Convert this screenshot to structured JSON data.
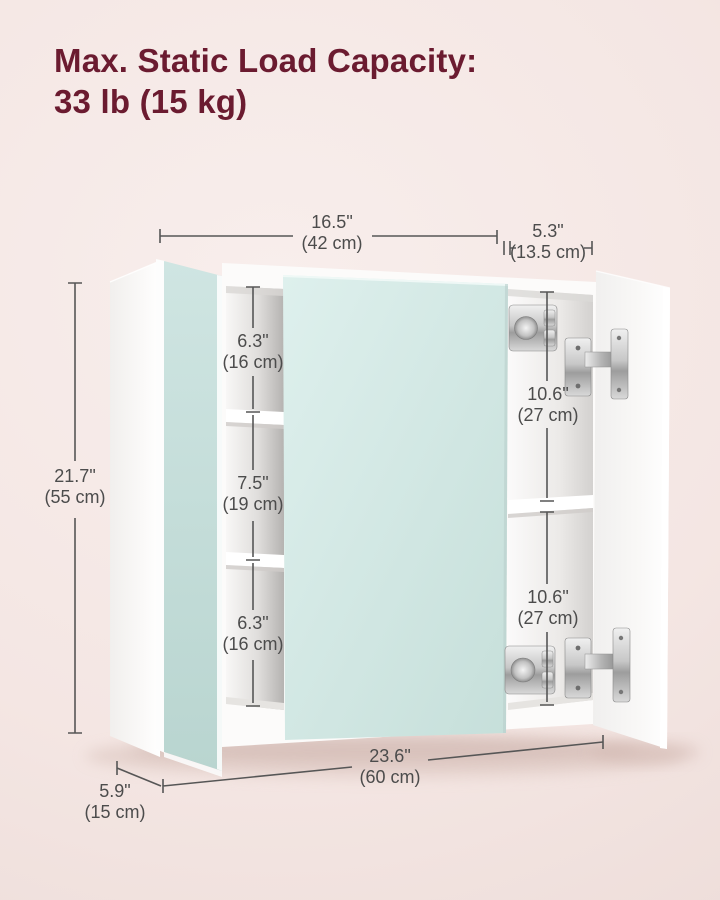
{
  "title": {
    "line1": "Max. Static Load Capacity:",
    "line2": "33 lb (15 kg)"
  },
  "colors": {
    "bg-a": "#f8eeec",
    "bg-b": "#ecdbd7",
    "title-color": "#6b1b30",
    "dim-text": "#4c4c4c",
    "dim-line": "#565656",
    "mirror-a": "#def0ed",
    "mirror-b": "#c6dfda"
  },
  "dimensions": {
    "top_width": {
      "inches": "16.5\"",
      "cm": "(42 cm)"
    },
    "door_width": {
      "inches": "5.3\"",
      "cm": "(13.5 cm)"
    },
    "height": {
      "inches": "21.7\"",
      "cm": "(55 cm)"
    },
    "left_shelf_top": {
      "inches": "6.3\"",
      "cm": "(16 cm)"
    },
    "left_shelf_middle": {
      "inches": "7.5\"",
      "cm": "(19 cm)"
    },
    "left_shelf_bottom": {
      "inches": "6.3\"",
      "cm": "(16 cm)"
    },
    "right_shelf_top": {
      "inches": "10.6\"",
      "cm": "(27 cm)"
    },
    "right_shelf_bottom": {
      "inches": "10.6\"",
      "cm": "(27 cm)"
    },
    "total_width": {
      "inches": "23.6\"",
      "cm": "(60 cm)"
    },
    "depth": {
      "inches": "5.9\"",
      "cm": "(15 cm)"
    }
  }
}
